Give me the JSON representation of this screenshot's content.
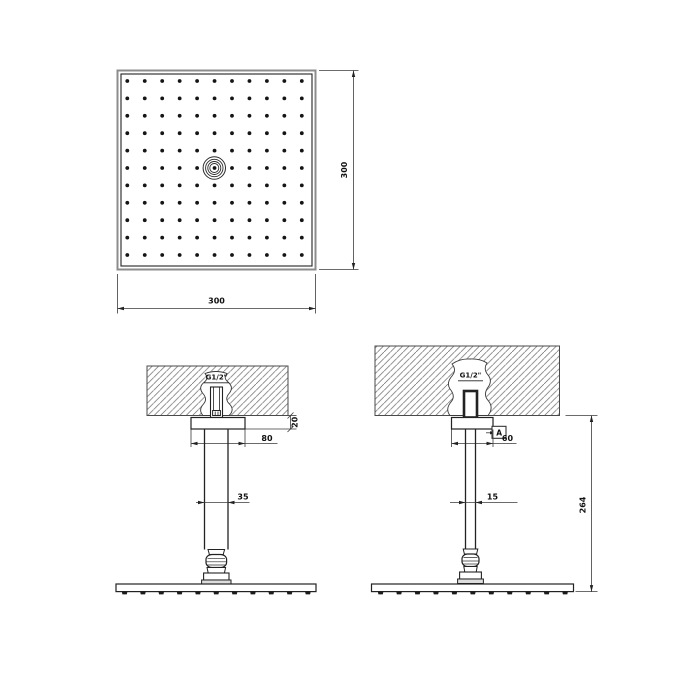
{
  "top_view": {
    "bottom_width_label": "300",
    "right_height_label": "300",
    "nozzle_grid": {
      "rows": 11,
      "cols": 11
    }
  },
  "front_view": {
    "thread_label": "G1/2\"",
    "rosette_width_label": "80",
    "rosette_height_label": "20",
    "arm_diameter_label": "35",
    "nozzle_count": 11
  },
  "side_view": {
    "thread_label": "G1/2\"",
    "rosette_width_label": "60",
    "arm_diameter_label": "15",
    "ceiling_to_head_label": "264",
    "section_marker_label": "A",
    "nozzle_count": 11
  },
  "colors": {
    "line": "#222222",
    "dimension_line": "#3a3a3a",
    "hatch": "#6b6b6b",
    "text": "#111111",
    "background": "#ffffff"
  }
}
